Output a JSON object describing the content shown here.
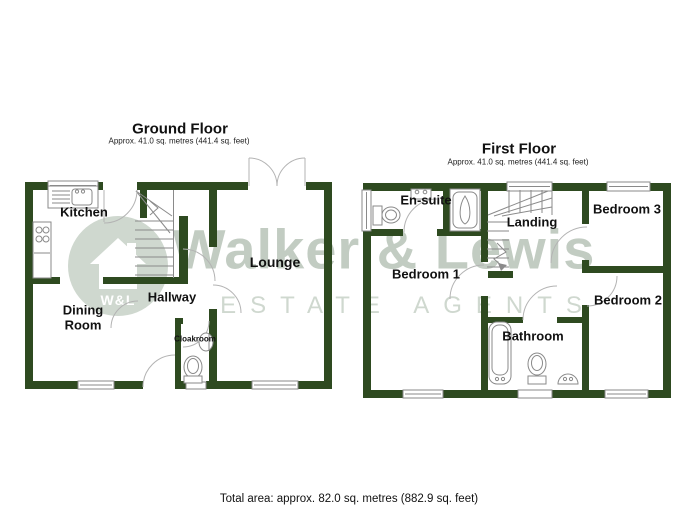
{
  "watermark": {
    "brand": "Walker & Lewis",
    "tagline": "ESTATE AGENTS",
    "monogram": "W&L"
  },
  "ground_floor": {
    "title": "Ground Floor",
    "area": "Approx. 41.0 sq. metres (441.4 sq. feet)",
    "rooms": {
      "kitchen": "Kitchen",
      "dining": "Dining Room",
      "hallway": "Hallway",
      "cloakroom": "Cloakroom",
      "lounge": "Lounge"
    }
  },
  "first_floor": {
    "title": "First Floor",
    "area": "Approx. 41.0 sq. metres (441.4 sq. feet)",
    "rooms": {
      "ensuite": "En-suite",
      "bedroom1": "Bedroom 1",
      "landing": "Landing",
      "bathroom": "Bathroom",
      "bedroom2": "Bedroom 2",
      "bedroom3": "Bedroom 3"
    }
  },
  "footer": {
    "total_area": "Total area: approx. 82.0 sq. metres (882.9 sq. feet)"
  },
  "colors": {
    "wall": "#2e4a20",
    "fixture": "#8a8a8a",
    "arc": "#b3b3b3",
    "watermark": "#c2ccc2",
    "watermark_light": "#cfd8cf"
  }
}
